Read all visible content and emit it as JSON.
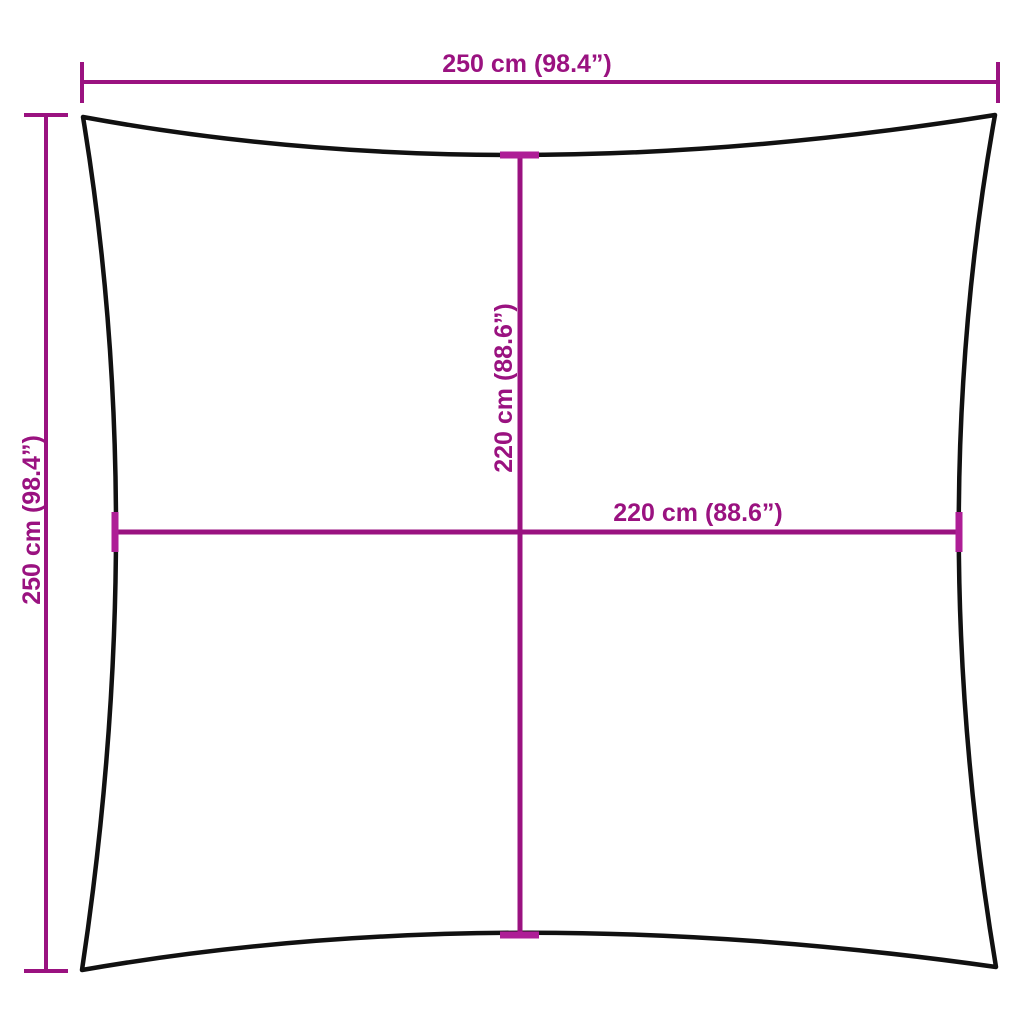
{
  "diagram": {
    "labels": {
      "top": "250 cm (98.4”)",
      "left": "250 cm (98.4”)",
      "inner_vertical": "220 cm (88.6”)",
      "inner_horizontal": "220 cm (88.6”)"
    },
    "colors": {
      "dimension": "#9A1280",
      "tick_accent": "#AE1E96",
      "outline": "#111111",
      "background": "#FFFFFF"
    }
  }
}
